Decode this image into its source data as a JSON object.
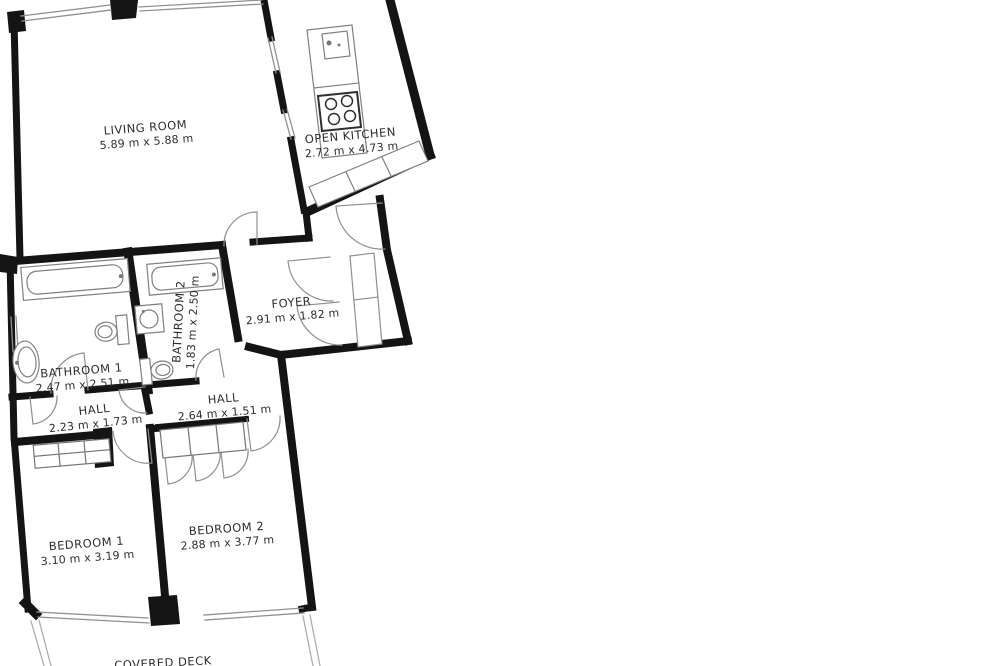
{
  "floor_plan": {
    "type": "apartment-floor-plan",
    "rooms": [
      {
        "name": "LIVING ROOM",
        "dims": "5.89 m x 5.88 m"
      },
      {
        "name": "OPEN KITCHEN",
        "dims": "2.72 m x 4.73 m"
      },
      {
        "name": "FOYER",
        "dims": "2.91 m x 1.82 m"
      },
      {
        "name": "BATHROOM 1",
        "dims": "2.47 m x 2.51 m"
      },
      {
        "name": "BATHROOM 2",
        "dims": "1.83 m x 2.50 m"
      },
      {
        "name": "HALL",
        "dims": "2.23 m x 1.73 m"
      },
      {
        "name": "HALL",
        "dims": "2.64 m x 1.51 m"
      },
      {
        "name": "BEDROOM 1",
        "dims": "3.10 m x 3.19 m"
      },
      {
        "name": "BEDROOM 2",
        "dims": "2.88 m x 3.77 m"
      },
      {
        "name": "COVERED DECK",
        "dims": ""
      }
    ],
    "fixtures": {
      "kitchen": [
        "sink-icon",
        "stove-icon",
        "counter-icon",
        "cabinets-icon"
      ],
      "bathroom1": [
        "bathtub-icon",
        "toilet-icon",
        "sink-icon"
      ],
      "bathroom2": [
        "bathtub-icon",
        "toilet-icon",
        "sink-icon"
      ],
      "bedroom1": [
        "wardrobe-icon"
      ],
      "bedroom2": [
        "wardrobe-icon"
      ]
    },
    "colors": {
      "wall": "#141414",
      "thin_line": "#8f8f8f",
      "text": "#2d2d2d",
      "background": "#ffffff"
    }
  }
}
